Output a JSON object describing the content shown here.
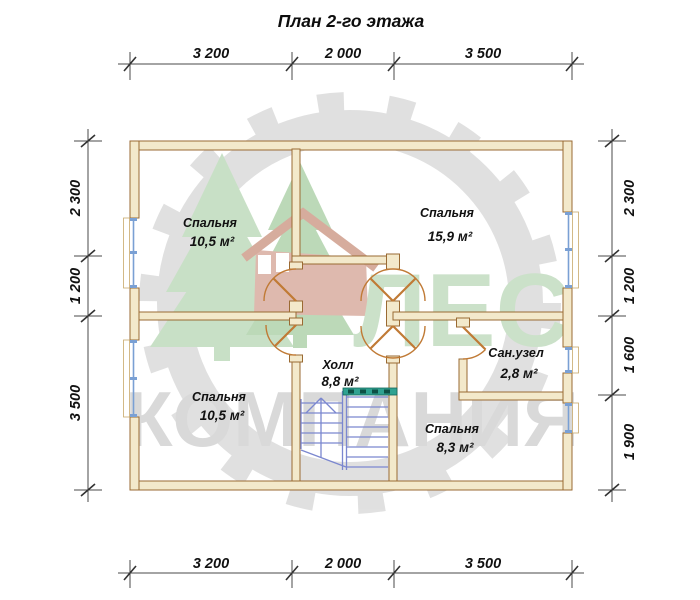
{
  "title": "План 2-го этажа",
  "dimensions": {
    "top": [
      "3 200",
      "2 000",
      "3 500"
    ],
    "bottom": [
      "3 200",
      "2 000",
      "3 500"
    ],
    "left": [
      "2 300",
      "1 200",
      "3 500"
    ],
    "right": [
      "2 300",
      "1 200",
      "1 600",
      "1 900"
    ]
  },
  "rooms": [
    {
      "name": "Спальня",
      "area": "10,5 м²"
    },
    {
      "name": "Спальня",
      "area": "15,9 м²"
    },
    {
      "name": "Холл",
      "area": "8,8 м²"
    },
    {
      "name": "Сан.узел",
      "area": "2,8 м²"
    },
    {
      "name": "Спальня",
      "area": "10,5 м²"
    },
    {
      "name": "Спальня",
      "area": "8,3 м²"
    }
  ],
  "watermark": {
    "line1": "ЛЕС",
    "line2": "КОМПАНИЯ"
  },
  "colors": {
    "wall_fill": "#f3e9cb",
    "wall_outline": "#9a6a33",
    "door_arc": "#c07a35",
    "window_frame": "#7aa0d4",
    "stairs": "#7b87cf",
    "railing": "#2fa291",
    "watermark_text_green": "#c9e0c7",
    "watermark_text_gray": "#d8d8d8",
    "logo_tree_green": "#c6dfc3",
    "logo_house_pink": "#ddb6aa",
    "logo_blade_gray": "#dfdfdf",
    "dimension_lines": "#4a4a4a",
    "text": "#111111"
  }
}
